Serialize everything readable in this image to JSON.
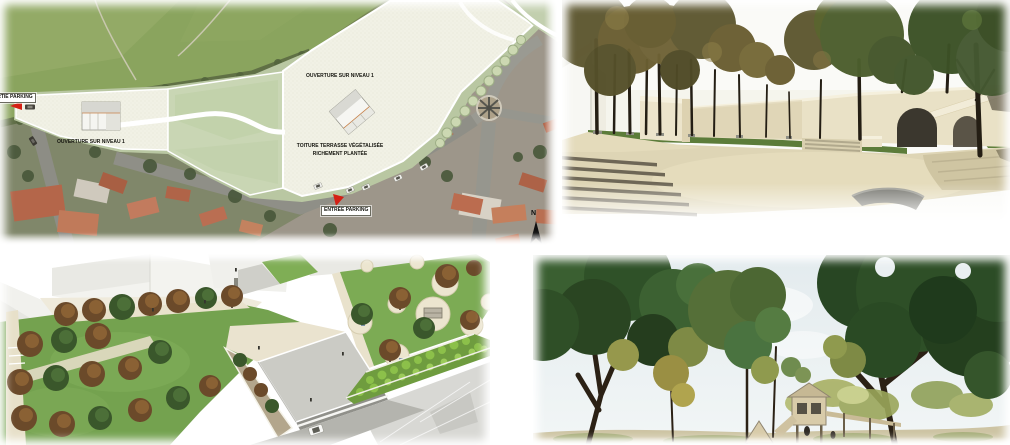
{
  "site_plan": {
    "labels": {
      "sortie_parking": "SORTIE PARKING",
      "ouverture_left": "OUVERTURE SUR NIVEAU 1",
      "ouverture_right": "OUVERTURE SUR NIVEAU 1",
      "toiture_line1": "TOITURE TERRASSE VÉGÉTALISÉE",
      "toiture_line2": "RICHEMENT PLANTÉE",
      "entree_parking": "ENTRÉE PARKING",
      "north": "N"
    },
    "colors": {
      "arrow_red": "#d42015",
      "plan_paper": "#f1f1e5",
      "plan_lawn": "#c9d6b4",
      "plan_lawn_band": "#b9c7a2",
      "field_green": "#8aa45e",
      "roof_terracotta": "#bb6c4f",
      "road_gray": "#96968e"
    }
  },
  "plaza_render": {
    "colors": {
      "wall_cream": "#e9e1c6",
      "plaza_beige": "#ded5b5",
      "lawn_green": "#5c7c3a",
      "foliage_olive": "#5e5730",
      "step_riser": "#6e6756",
      "arch_dark": "#3b372e"
    }
  },
  "park_render": {
    "colors": {
      "lawn_green": "#74a24f",
      "path_cream": "#e9e2cc",
      "canopy_brown": "#6b4a2a",
      "canopy_green": "#3a572b",
      "building_white": "#f3f3ef",
      "hedge_green": "#8cc04a"
    }
  },
  "alley_render": {
    "colors": {
      "sky_blue": "#e6edf0",
      "canopy_dark_green": "#2e4f27",
      "canopy_yellow": "#9a9a4d",
      "playground_beige": "#d8cba9"
    }
  }
}
